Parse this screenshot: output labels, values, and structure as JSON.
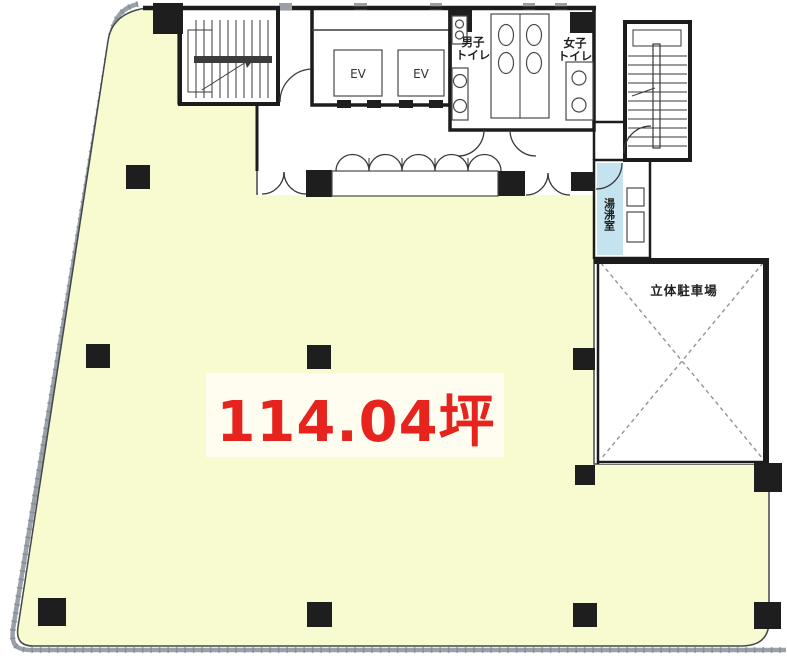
{
  "floor_plan": {
    "area_label": "114.04坪",
    "rooms": {
      "elevator_1": "EV",
      "elevator_2": "EV",
      "mens_toilet_line1": "男子",
      "mens_toilet_line2": "トイレ",
      "womens_toilet_line1": "女子",
      "womens_toilet_line2": "トイレ",
      "kitchenette": "湯沸室",
      "parking": "立体駐車場"
    },
    "colors": {
      "floor": "#f8facf",
      "wet_area": "#c4e3ee",
      "wall": "#1c1c1c",
      "boundary": "#9aa1a8",
      "area_label_red": "#e6231d"
    }
  }
}
